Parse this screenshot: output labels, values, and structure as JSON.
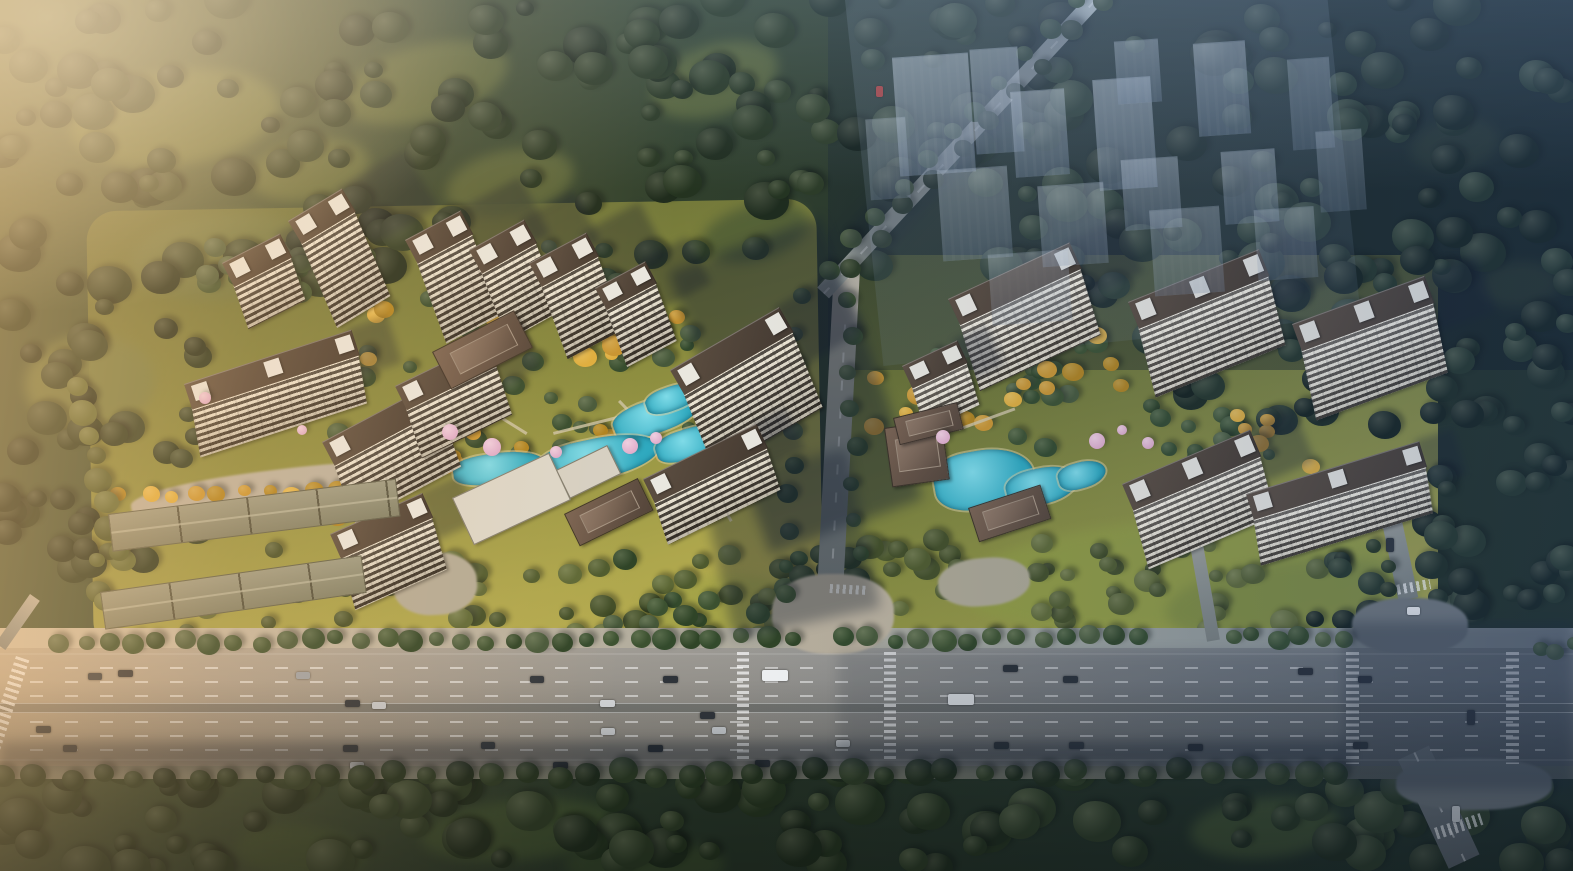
{
  "meta": {
    "label": "Aerial architectural rendering of a Chinese residential master-plan: two high-rise apartment clusters with landscaped pool courtyards, surrounding forest, a wide multi-lane boulevard with traffic in the foreground, and a translucent future-phase district at the upper right",
    "canvas": {
      "width": 1573,
      "height": 871
    }
  },
  "palette": {
    "forest_base": "#273528",
    "forest_deep": "#15211a",
    "meadow": "#66713f",
    "lawn": "#a8a346",
    "gold": "#c99531",
    "pool": "#2fa9bf",
    "pool_light": "#7fdbe8",
    "roof": "#53463c",
    "penthouse": "#e9e7df",
    "facade_light": "#efe7d3",
    "facade_dark": "#3f382e",
    "road_warm": "#b5a48c",
    "road_dark": "#5e6468",
    "marking": "#ffffff",
    "ghost": "#9fb2c6",
    "blossom": "#dfaccb",
    "shadow": "#16202e"
  },
  "colorsets": {
    "greens": [
      "#3c5130",
      "#2f4427",
      "#46583a",
      "#334a2c"
    ],
    "dark": [
      "#24331f",
      "#2c3b25",
      "#1e2b1c"
    ],
    "deep": [
      "#14201a",
      "#1c2a20",
      "#243427"
    ],
    "olive": [
      "#4e5a2e",
      "#5d6836",
      "#424e28"
    ],
    "golds": [
      "#c99531",
      "#dfae3e",
      "#b0831f"
    ]
  },
  "legend": {
    "meadows": "[x,y,w,h,rot,color] soft lawn/clearing ellipse",
    "scatters": "{x,y,w,h,n,r0,r1,cs,seed} random tree-canopy blobs",
    "tree_rows": "{x0,y0,x1,y1,n,r,cs,seed} evenly spaced street trees",
    "towers": "[x,y,rot,len,depth,facadeH] apartment slab: dark roof + striped balcony facade",
    "lowrise": "[x,y,rot,len,depth] long gabled low-rise strip",
    "flats": "[x,y,w,h,rot,color] flat white amenity roof",
    "pavilions": "[x,y,w,h,rot] brown Chinese-style clubhouse/gate roof",
    "pools": "[x,y,w,h,rot] turquoise landscape pool",
    "blossoms": "[x,y,r] pink blossom tree",
    "paths": "[x,y,w,h,rot] light garden path",
    "ghost_blocks": "[x,y,w,h,opacity] translucent future-phase massing",
    "shadows": "[x,y,w,h,rot,opacity] cast-shadow patch",
    "cars": "[x,y,w,h,color] vehicle on road",
    "crosswalks": "[x,y,w,h,type,rot] zebra crossing",
    "segments": "{x,y,w,h,rot,g,dash} secondary road"
  },
  "meadows": [
    [
      70,
      70,
      210,
      95,
      -8,
      "#66713f"
    ],
    [
      340,
      45,
      170,
      75,
      -15,
      "#5f6a3b"
    ],
    [
      130,
      215,
      190,
      85,
      -5,
      "#6b7542"
    ],
    [
      445,
      150,
      130,
      65,
      -12,
      "#5c673a"
    ],
    [
      650,
      45,
      130,
      70,
      -18,
      "#586539"
    ],
    [
      25,
      335,
      130,
      95,
      -4,
      "#707a44"
    ],
    [
      700,
      205,
      110,
      55,
      -15,
      "#525f35"
    ],
    [
      250,
      140,
      120,
      60,
      -10,
      "#616c3d"
    ],
    [
      1410,
      120,
      90,
      50,
      -10,
      "#37462e"
    ],
    [
      1480,
      262,
      80,
      45,
      -5,
      "#3a4930"
    ],
    [
      420,
      800,
      200,
      60,
      -5,
      "#3f5130"
    ],
    [
      235,
      825,
      130,
      55,
      5,
      "#3a4c2d"
    ],
    [
      1190,
      798,
      150,
      60,
      -5,
      "#3f5130"
    ],
    [
      565,
      840,
      160,
      50,
      0,
      "#37482c"
    ],
    [
      960,
      520,
      430,
      110,
      -4,
      "#8f9a42"
    ],
    [
      1165,
      560,
      255,
      80,
      -6,
      "#7d8a3e"
    ],
    [
      640,
      575,
      160,
      60,
      -4,
      "#a3a348"
    ]
  ],
  "scatters": [
    {
      "x": 0,
      "y": 0,
      "w": 830,
      "h": 295,
      "n": 115,
      "r0": 9,
      "r1": 23,
      "cs": "dark",
      "seed": 1
    },
    {
      "x": 0,
      "y": 280,
      "w": 200,
      "h": 300,
      "n": 38,
      "r0": 9,
      "r1": 20,
      "cs": "dark",
      "seed": 2
    },
    {
      "x": 828,
      "y": 0,
      "w": 745,
      "h": 300,
      "n": 105,
      "r0": 9,
      "r1": 24,
      "cs": "deep",
      "seed": 3
    },
    {
      "x": 1150,
      "y": 260,
      "w": 423,
      "h": 170,
      "n": 48,
      "r0": 9,
      "r1": 20,
      "cs": "deep",
      "seed": 4
    },
    {
      "x": 1426,
      "y": 400,
      "w": 147,
      "h": 270,
      "n": 36,
      "r0": 9,
      "r1": 19,
      "cs": "deep",
      "seed": 5
    },
    {
      "x": 0,
      "y": 758,
      "w": 1573,
      "h": 113,
      "n": 125,
      "r0": 10,
      "r1": 25,
      "cs": "dark",
      "seed": 6
    },
    {
      "x": 95,
      "y": 545,
      "w": 690,
      "h": 95,
      "n": 52,
      "r0": 7,
      "r1": 14,
      "cs": "olive",
      "seed": 7
    },
    {
      "x": 840,
      "y": 540,
      "w": 500,
      "h": 100,
      "n": 42,
      "r0": 7,
      "r1": 14,
      "cs": "olive",
      "seed": 8
    },
    {
      "x": 330,
      "y": 325,
      "w": 420,
      "h": 150,
      "n": 36,
      "r0": 6,
      "r1": 12,
      "cs": "greens",
      "seed": 9
    },
    {
      "x": 880,
      "y": 345,
      "w": 390,
      "h": 120,
      "n": 28,
      "r0": 6,
      "r1": 12,
      "cs": "greens",
      "seed": 10
    },
    {
      "x": 205,
      "y": 238,
      "w": 440,
      "h": 66,
      "n": 22,
      "r0": 7,
      "r1": 13,
      "cs": "greens",
      "seed": 23
    },
    {
      "x": 335,
      "y": 298,
      "w": 355,
      "h": 68,
      "n": 16,
      "r0": 6,
      "r1": 12,
      "cs": "golds",
      "seed": 24
    },
    {
      "x": 390,
      "y": 418,
      "w": 330,
      "h": 66,
      "n": 18,
      "r0": 6,
      "r1": 12,
      "cs": "golds",
      "seed": 25
    },
    {
      "x": 205,
      "y": 462,
      "w": 245,
      "h": 58,
      "n": 11,
      "r0": 6,
      "r1": 11,
      "cs": "golds",
      "seed": 26
    },
    {
      "x": 868,
      "y": 378,
      "w": 280,
      "h": 58,
      "n": 15,
      "r0": 6,
      "r1": 12,
      "cs": "golds",
      "seed": 27
    },
    {
      "x": 1012,
      "y": 330,
      "w": 140,
      "h": 48,
      "n": 8,
      "r0": 6,
      "r1": 11,
      "cs": "golds",
      "seed": 28
    },
    {
      "x": 1228,
      "y": 412,
      "w": 112,
      "h": 58,
      "n": 8,
      "r0": 6,
      "r1": 11,
      "cs": "golds",
      "seed": 29
    },
    {
      "x": 612,
      "y": 560,
      "w": 200,
      "h": 70,
      "n": 14,
      "r0": 7,
      "r1": 13,
      "cs": "greens",
      "seed": 30
    },
    {
      "x": 1295,
      "y": 556,
      "w": 115,
      "h": 92,
      "n": 14,
      "r0": 8,
      "r1": 15,
      "cs": "deep",
      "seed": 31
    },
    {
      "x": 780,
      "y": 556,
      "w": 90,
      "h": 86,
      "n": 12,
      "r0": 8,
      "r1": 14,
      "cs": "dark",
      "seed": 32
    }
  ],
  "tree_rows": [
    {
      "x0": 58,
      "y0": 644,
      "x1": 790,
      "y1": 639,
      "n": 30,
      "r": 10,
      "cs": "greens",
      "seed": 11
    },
    {
      "x0": 846,
      "y0": 641,
      "x1": 1142,
      "y1": 639,
      "n": 13,
      "r": 10,
      "cs": "greens",
      "seed": 12
    },
    {
      "x0": 1233,
      "y0": 639,
      "x1": 1345,
      "y1": 639,
      "n": 6,
      "r": 10,
      "cs": "greens",
      "seed": 13
    },
    {
      "x0": 4,
      "y0": 778,
      "x1": 1340,
      "y1": 772,
      "n": 42,
      "r": 12,
      "cs": "dark",
      "seed": 14
    },
    {
      "x0": 1079,
      "y0": 2,
      "x1": 829,
      "y1": 270,
      "n": 11,
      "r": 9,
      "cs": "greens",
      "seed": 15
    },
    {
      "x0": 1102,
      "y0": 6,
      "x1": 850,
      "y1": 268,
      "n": 10,
      "r": 9,
      "cs": "dark",
      "seed": 16
    },
    {
      "x0": 800,
      "y0": 300,
      "x1": 788,
      "y1": 598,
      "n": 10,
      "r": 9,
      "cs": "greens",
      "seed": 17
    },
    {
      "x0": 848,
      "y0": 300,
      "x1": 858,
      "y1": 556,
      "n": 8,
      "r": 9,
      "cs": "greens",
      "seed": 18
    },
    {
      "x0": 122,
      "y0": 496,
      "x1": 392,
      "y1": 492,
      "n": 12,
      "r": 8,
      "cs": "golds",
      "seed": 19
    },
    {
      "x0": 1352,
      "y0": 478,
      "x1": 1392,
      "y1": 592,
      "n": 6,
      "r": 9,
      "cs": "dark",
      "seed": 20
    },
    {
      "x0": 78,
      "y0": 388,
      "x1": 118,
      "y1": 552,
      "n": 8,
      "r": 12,
      "cs": "olive",
      "seed": 21
    },
    {
      "x0": 1540,
      "y0": 652,
      "x1": 1572,
      "y1": 648,
      "n": 3,
      "r": 9,
      "cs": "greens",
      "seed": 22
    }
  ],
  "towers_left": [
    [
      222,
      289,
      -27,
      64,
      26,
      46
    ],
    [
      288,
      247,
      -31,
      62,
      26,
      92
    ],
    [
      405,
      266,
      -28,
      62,
      26,
      86
    ],
    [
      469,
      276,
      -29,
      62,
      26,
      73
    ],
    [
      529,
      289,
      -28,
      64,
      26,
      78
    ],
    [
      595,
      312,
      -28,
      56,
      24,
      62
    ],
    [
      670,
      398,
      -30,
      125,
      28,
      82
    ],
    [
      184,
      410,
      -18,
      175,
      26,
      50
    ],
    [
      322,
      468,
      -28,
      120,
      26,
      62
    ],
    [
      395,
      412,
      -26,
      100,
      26,
      52
    ],
    [
      643,
      505,
      -26,
      125,
      26,
      45
    ],
    [
      330,
      560,
      -24,
      100,
      26,
      55
    ]
  ],
  "towers_right": [
    [
      948,
      327,
      -25,
      133,
      28,
      70
    ],
    [
      1128,
      330,
      -22,
      140,
      28,
      72
    ],
    [
      1292,
      352,
      -20,
      140,
      28,
      72
    ],
    [
      1122,
      512,
      -23,
      138,
      28,
      62
    ],
    [
      1246,
      520,
      -17,
      180,
      26,
      48
    ],
    [
      902,
      390,
      -25,
      60,
      24,
      45
    ]
  ],
  "lowrise": [
    [
      108,
      514,
      -7,
      288,
      36
    ],
    [
      100,
      592,
      -8,
      262,
      36
    ]
  ],
  "flats": [
    [
      452,
      498,
      105,
      50,
      -25,
      "#dcd7ca"
    ],
    [
      556,
      470,
      55,
      30,
      -26,
      "#d6d1c4"
    ]
  ],
  "pavilions": [
    [
      432,
      352,
      90,
      40,
      -27
    ],
    [
      564,
      514,
      80,
      34,
      -26
    ],
    [
      884,
      428,
      56,
      58,
      -8
    ],
    [
      968,
      508,
      74,
      34,
      -18
    ],
    [
      893,
      418,
      64,
      26,
      -14
    ]
  ],
  "pools": [
    [
      612,
      398,
      92,
      34,
      -20
    ],
    [
      538,
      438,
      122,
      40,
      -12
    ],
    [
      453,
      453,
      92,
      30,
      -8
    ],
    [
      406,
      423,
      42,
      26,
      -25
    ],
    [
      655,
      428,
      72,
      30,
      -18
    ],
    [
      645,
      386,
      56,
      24,
      -20
    ],
    [
      934,
      450,
      100,
      58,
      -10
    ],
    [
      1006,
      468,
      72,
      36,
      -14
    ],
    [
      1058,
      462,
      48,
      26,
      -16
    ]
  ],
  "blossoms": [
    [
      450,
      432,
      8
    ],
    [
      492,
      447,
      9
    ],
    [
      630,
      446,
      8
    ],
    [
      656,
      438,
      6
    ],
    [
      556,
      452,
      6
    ],
    [
      302,
      430,
      5
    ],
    [
      943,
      437,
      7
    ],
    [
      1097,
      441,
      8
    ],
    [
      1148,
      443,
      6
    ],
    [
      1122,
      430,
      5
    ],
    [
      205,
      398,
      6
    ]
  ],
  "paths": [
    [
      470,
      400,
      3,
      66,
      -58
    ],
    [
      553,
      432,
      66,
      3,
      -14
    ],
    [
      618,
      402,
      3,
      58,
      -44
    ],
    [
      958,
      428,
      60,
      3,
      -20
    ],
    [
      700,
      470,
      3,
      60,
      -30
    ]
  ],
  "ghost_wash": [
    845,
    0,
    480,
    368,
    -6,
    0.2
  ],
  "ghost_blocks": [
    [
      896,
      55,
      76,
      118,
      0.5
    ],
    [
      973,
      48,
      48,
      104,
      0.45
    ],
    [
      1013,
      90,
      54,
      85,
      0.45
    ],
    [
      1096,
      78,
      58,
      110,
      0.5
    ],
    [
      1116,
      40,
      44,
      62,
      0.4
    ],
    [
      1196,
      42,
      52,
      92,
      0.45
    ],
    [
      1123,
      158,
      57,
      70,
      0.4
    ],
    [
      1223,
      150,
      54,
      72,
      0.4
    ],
    [
      940,
      168,
      70,
      90,
      0.36
    ],
    [
      1040,
      184,
      66,
      80,
      0.36
    ],
    [
      1152,
      208,
      70,
      85,
      0.33
    ],
    [
      1256,
      208,
      60,
      70,
      0.3
    ],
    [
      868,
      118,
      40,
      80,
      0.32
    ],
    [
      1290,
      58,
      42,
      90,
      0.32
    ],
    [
      1318,
      130,
      46,
      80,
      0.3
    ],
    [
      990,
      252,
      80,
      70,
      0.28
    ]
  ],
  "roads": {
    "main": {
      "y": 648,
      "h": 118
    },
    "sidewalk_top": {
      "y": 628,
      "h": 20
    },
    "sidewalk_bottom": {
      "y": 766,
      "h": 13
    },
    "lane_dash_y": [
      667,
      681,
      695,
      721,
      735,
      749
    ],
    "edge_y": [
      653,
      759
    ],
    "median_y": 703,
    "segments": [
      {
        "x": 834,
        "y": 268,
        "w": 26,
        "h": 384,
        "rot": 3,
        "g": "mid",
        "dash": true
      },
      {
        "x": 1089,
        "y": -6,
        "w": 16,
        "h": 400,
        "rot": 42.8,
        "g": "top",
        "dash": true
      },
      {
        "x": 1372,
        "y": 476,
        "w": 20,
        "h": 128,
        "rot": -12,
        "g": "mid",
        "dash": false
      },
      {
        "x": 1398,
        "y": 760,
        "w": 34,
        "h": 120,
        "rot": -25,
        "g": "darkseg",
        "dash": true
      },
      {
        "x": 1181,
        "y": 494,
        "w": 13,
        "h": 150,
        "rot": -10,
        "g": "mid",
        "dash": false
      },
      {
        "x": 30,
        "y": 594,
        "w": 12,
        "h": 60,
        "rot": 35,
        "g": "mid",
        "dash": false
      }
    ],
    "plazas": [
      [
        772,
        574,
        122,
        80,
        0,
        "#b7ae9c"
      ],
      [
        938,
        558,
        92,
        48,
        -5,
        "#aaa592"
      ],
      [
        393,
        553,
        84,
        62,
        -3,
        "#b3ab97"
      ],
      [
        1352,
        598,
        116,
        56,
        0,
        "#6e7478"
      ],
      [
        1396,
        758,
        156,
        52,
        0,
        "#676d71"
      ],
      [
        130,
        470,
        290,
        40,
        -7,
        "#b9b1a0"
      ]
    ],
    "crosswalks": [
      [
        737,
        652,
        12,
        110,
        "v",
        0
      ],
      [
        884,
        652,
        12,
        110,
        "v",
        0
      ],
      [
        1346,
        652,
        13,
        112,
        "v",
        0
      ],
      [
        1506,
        652,
        13,
        112,
        "v",
        0
      ],
      [
        16,
        656,
        14,
        106,
        "v",
        18
      ],
      [
        1390,
        586,
        40,
        10,
        "h",
        -10
      ],
      [
        1434,
        828,
        48,
        12,
        "h",
        -18
      ],
      [
        830,
        584,
        36,
        9,
        "h",
        3
      ]
    ]
  },
  "cars": [
    [
      118,
      670,
      15,
      7,
      "#2b3037"
    ],
    [
      88,
      673,
      14,
      7,
      "#343a41"
    ],
    [
      296,
      672,
      14,
      7,
      "#9aa0a6"
    ],
    [
      530,
      676,
      14,
      7,
      "#30353b"
    ],
    [
      345,
      700,
      15,
      7,
      "#2e333a"
    ],
    [
      372,
      702,
      14,
      7,
      "#c9ccd0"
    ],
    [
      600,
      700,
      15,
      7,
      "#d6d8da"
    ],
    [
      663,
      676,
      15,
      7,
      "#2e3339"
    ],
    [
      762,
      670,
      26,
      11,
      "#eef0f1"
    ],
    [
      700,
      712,
      15,
      7,
      "#30353b"
    ],
    [
      712,
      727,
      14,
      7,
      "#c2c6ca"
    ],
    [
      648,
      745,
      15,
      7,
      "#2b3036"
    ],
    [
      343,
      745,
      15,
      7,
      "#2d3238"
    ],
    [
      350,
      762,
      14,
      7,
      "#c9cbcd"
    ],
    [
      553,
      762,
      15,
      7,
      "#2b3036"
    ],
    [
      755,
      760,
      15,
      7,
      "#2e3237"
    ],
    [
      481,
      742,
      14,
      7,
      "#30353b"
    ],
    [
      601,
      728,
      14,
      7,
      "#c7c9cb"
    ],
    [
      36,
      726,
      15,
      7,
      "#2b3036"
    ],
    [
      63,
      745,
      14,
      7,
      "#2e3237"
    ],
    [
      1003,
      665,
      15,
      7,
      "#2a3036"
    ],
    [
      1063,
      676,
      15,
      7,
      "#2c3137"
    ],
    [
      948,
      694,
      26,
      11,
      "#e9ebec"
    ],
    [
      1069,
      742,
      15,
      7,
      "#33383e"
    ],
    [
      994,
      742,
      15,
      7,
      "#2e3338"
    ],
    [
      1188,
      744,
      15,
      7,
      "#2a2f34"
    ],
    [
      1298,
      668,
      15,
      7,
      "#292e33"
    ],
    [
      1358,
      676,
      14,
      7,
      "#2b3036"
    ],
    [
      1353,
      742,
      15,
      7,
      "#2d3237"
    ],
    [
      836,
      740,
      14,
      7,
      "#d0d2d4"
    ],
    [
      1407,
      607,
      13,
      8,
      "#e8e9ea"
    ],
    [
      876,
      86,
      7,
      11,
      "#b23430"
    ],
    [
      1452,
      806,
      8,
      16,
      "#c8cacc"
    ],
    [
      1467,
      710,
      8,
      15,
      "#2e3338"
    ],
    [
      1386,
      538,
      8,
      14,
      "#2c3136"
    ]
  ],
  "shadows": [
    [
      668,
      272,
      162,
      300,
      -20,
      0.45
    ],
    [
      700,
      480,
      150,
      162,
      -12,
      0.36
    ],
    [
      1345,
      622,
      228,
      168,
      0,
      0.32
    ],
    [
      0,
      742,
      1350,
      26,
      0,
      0.36
    ],
    [
      838,
      650,
      512,
      112,
      0,
      0.14
    ],
    [
      1062,
      -4,
      46,
      330,
      42.8,
      0.35
    ]
  ]
}
